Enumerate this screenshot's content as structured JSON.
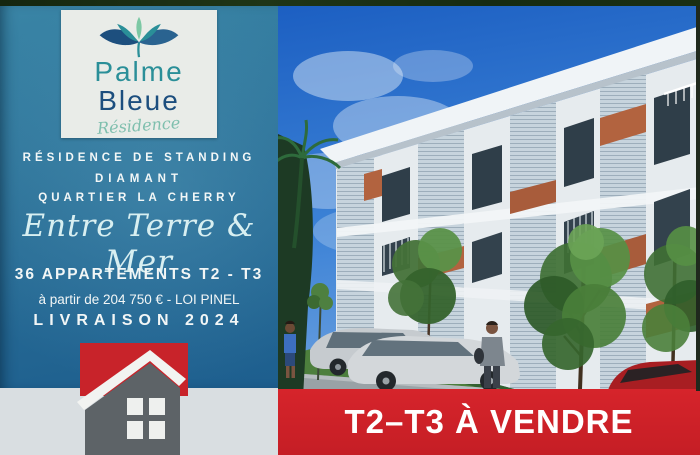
{
  "billboard": {
    "logo": {
      "icon": "palm-flower-icon",
      "brand_top": "Palme",
      "brand_bottom": "Bleue",
      "subtitle": "Résidence"
    },
    "left_panel": {
      "heading_line1": "RÉSIDENCE DE STANDING",
      "heading_line2": "DIAMANT",
      "heading_line3": "QUARTIER LA CHERRY",
      "tagline": "Entre Terre & Mer",
      "apartments_line": "36 APPARTEMENTS T2 - T3",
      "price_line": "à partir de 204 750 € - LOI PINEL",
      "delivery_line": "LIVRAISON 2024"
    },
    "house_badge": {
      "icon": "house-icon"
    },
    "sale_banner": {
      "text": "T2–T3 À VENDRE"
    },
    "rendering_description": "apartment-building-3d-rendering",
    "colors": {
      "panel_blue": "#2a6f99",
      "brand_teal": "#2a8f98",
      "brand_navy": "#1c4e7e",
      "script_teal": "#7fbfae",
      "accent_red": "#d0222a",
      "sky_blue": "#2f74cd",
      "terracotta": "#b2633f"
    }
  }
}
